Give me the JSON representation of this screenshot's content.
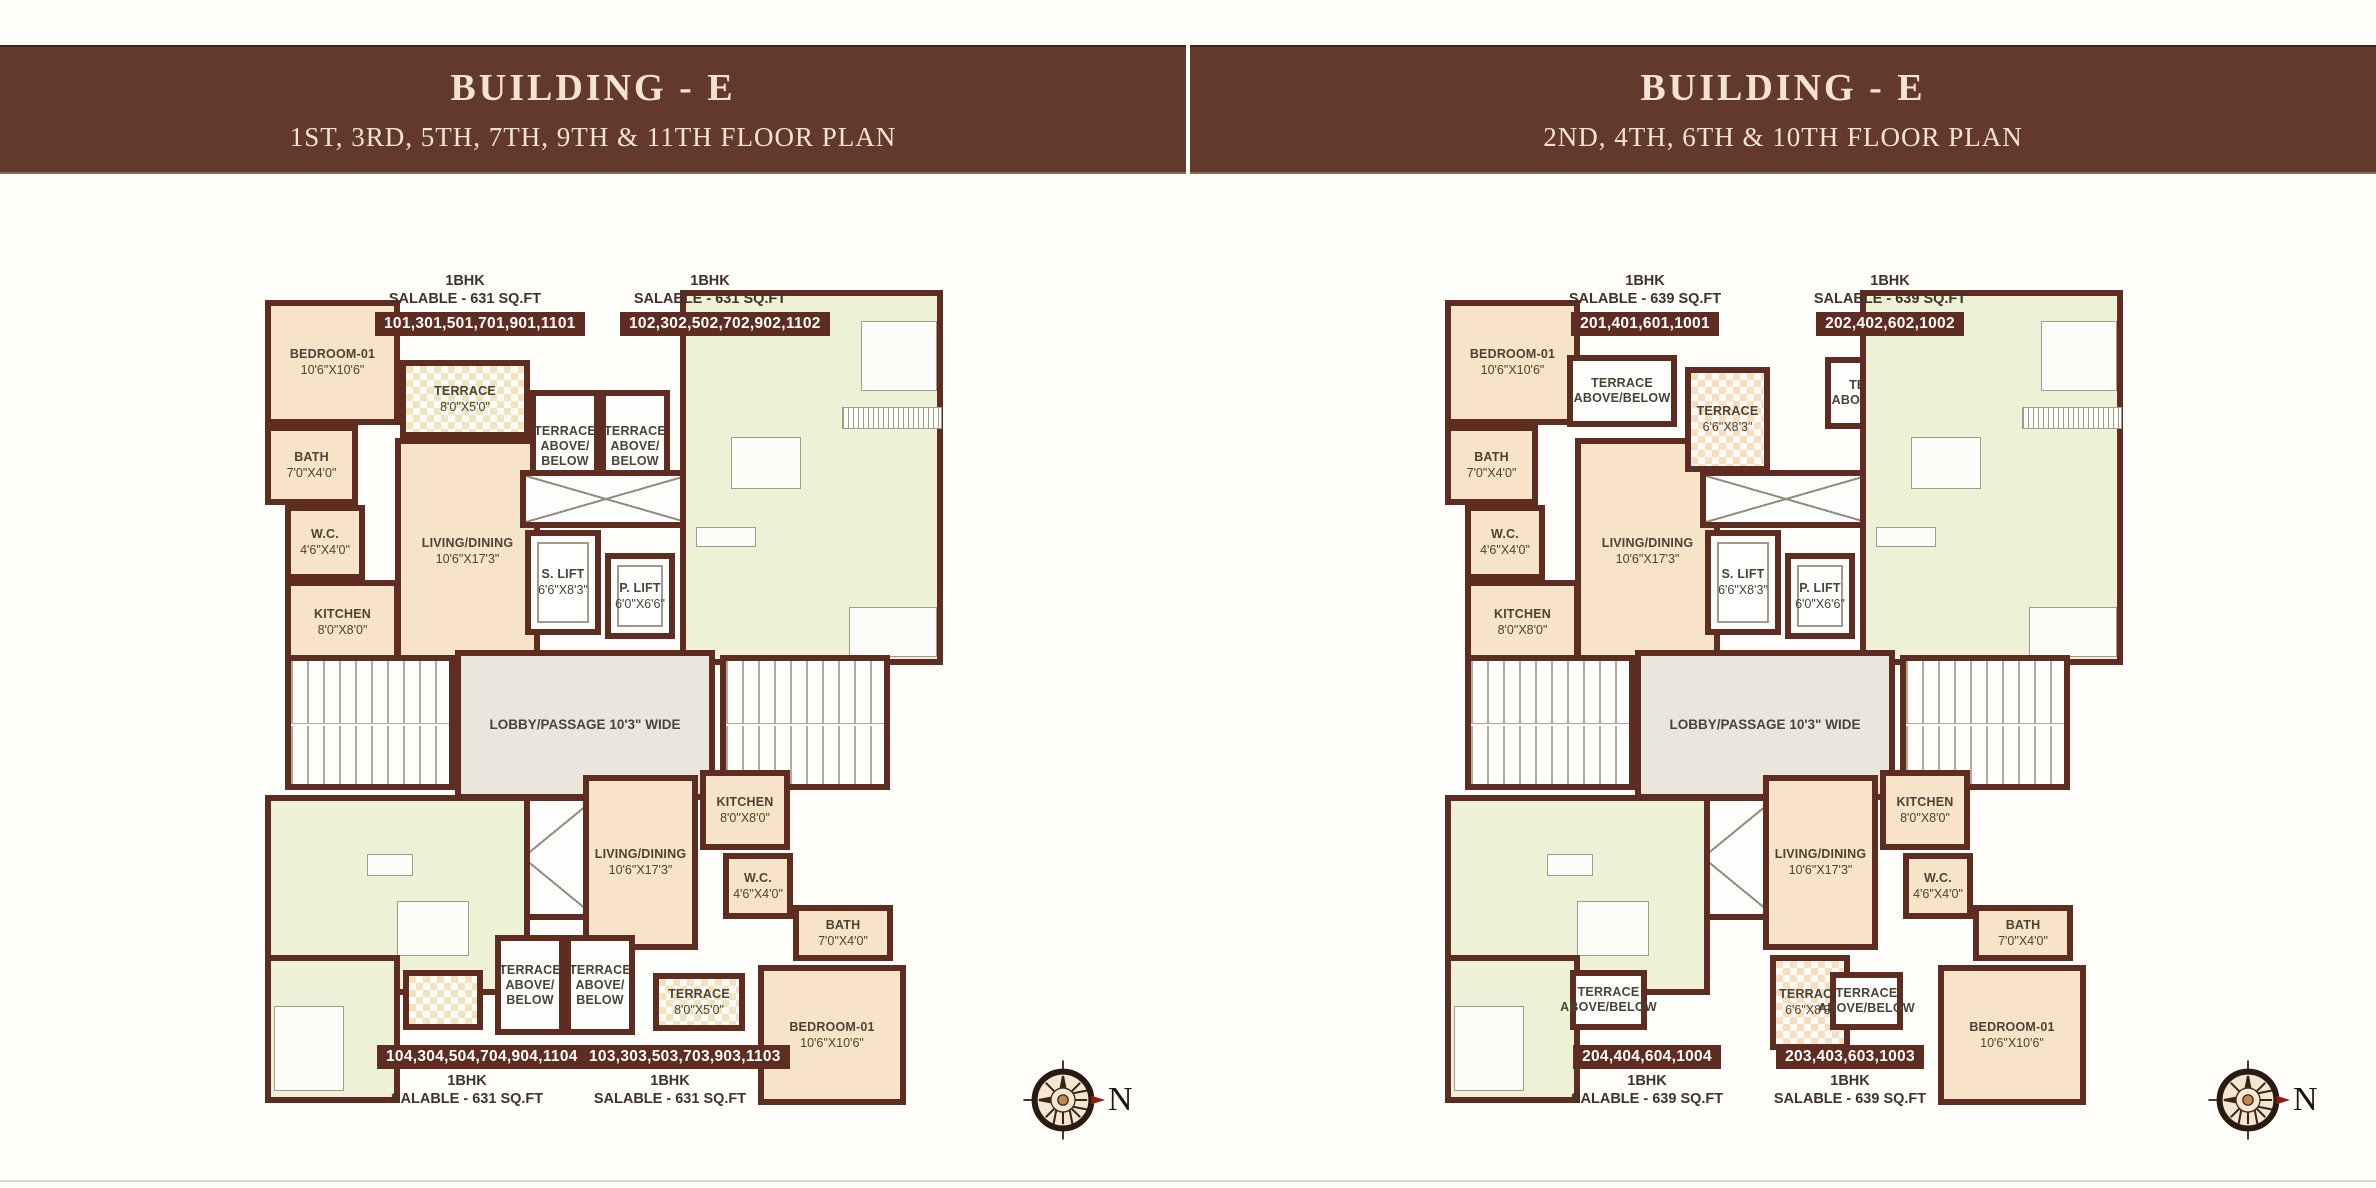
{
  "headers": [
    {
      "title": "BUILDING - E",
      "subtitle": "1ST, 3RD, 5TH, 7TH, 9TH & 11TH FLOOR PLAN"
    },
    {
      "title": "BUILDING - E",
      "subtitle": "2ND, 4TH, 6TH & 10TH FLOOR PLAN"
    }
  ],
  "colors": {
    "header_bg": "#63392b",
    "header_text": "#f2e3d3",
    "wall": "#5e2c20",
    "unit_peach": "#f7e3c7",
    "unit_green": "#edf1d6",
    "terrace_cream": "#f2e2bd",
    "lobby_grey": "#eae6dc",
    "badge_bg": "#5e2c20",
    "badge_text": "#ffffff",
    "compass_arrow_red": "#8d1d14"
  },
  "plans": [
    {
      "units": {
        "top_left": {
          "type": "1BHK",
          "salable": "SALABLE - 631 SQ.FT",
          "numbers": "101,301,501,701,901,1101"
        },
        "top_right": {
          "type": "1BHK",
          "salable": "SALABLE - 631 SQ.FT",
          "numbers": "102,302,502,702,902,1102"
        },
        "bottom_left": {
          "type": "1BHK",
          "salable": "SALABLE - 631 SQ.FT",
          "numbers": "104,304,504,704,904,1104"
        },
        "bottom_right": {
          "type": "1BHK",
          "salable": "SALABLE - 631 SQ.FT",
          "numbers": "103,303,503,703,903,1103"
        }
      },
      "rooms": {
        "bedroom": "BEDROOM-01",
        "bedroom_dims": "10'6\"X10'6\"",
        "bath": "BATH",
        "bath_dims": "7'0\"X4'0\"",
        "wc": "W.C.",
        "wc_dims": "4'6\"X4'0\"",
        "kitchen": "KITCHEN",
        "kitchen_dims": "8'0\"X8'0\"",
        "living": "LIVING/DINING",
        "living_dims": "10'6\"X17'3\"",
        "s_lift": "S. LIFT",
        "s_lift_dims": "6'6\"X8'3\"",
        "p_lift": "P. LIFT",
        "p_lift_dims": "6'0\"X6'6\"",
        "lobby": "LOBBY/PASSAGE 10'3\" WIDE"
      },
      "terraces": {
        "top": [
          {
            "name": "TERRACE",
            "dims": "8'0\"X5'0\""
          },
          {
            "name": "TERRACE ABOVE/ BELOW"
          },
          {
            "name": "TERRACE ABOVE/ BELOW"
          }
        ],
        "bottom": [
          {
            "name": "TERRACE ABOVE/ BELOW"
          },
          {
            "name": "TERRACE ABOVE/ BELOW"
          },
          {
            "name": "TERRACE",
            "dims": "8'0\"X5'0\""
          }
        ]
      },
      "compass": "N"
    },
    {
      "units": {
        "top_left": {
          "type": "1BHK",
          "salable": "SALABLE - 639 SQ.FT",
          "numbers": "201,401,601,1001"
        },
        "top_right": {
          "type": "1BHK",
          "salable": "SALABLE - 639 SQ.FT",
          "numbers": "202,402,602,1002"
        },
        "bottom_left": {
          "type": "1BHK",
          "salable": "SALABLE - 639 SQ.FT",
          "numbers": "204,404,604,1004"
        },
        "bottom_right": {
          "type": "1BHK",
          "salable": "SALABLE - 639 SQ.FT",
          "numbers": "203,403,603,1003"
        }
      },
      "rooms": {
        "bedroom": "BEDROOM-01",
        "bedroom_dims": "10'6\"X10'6\"",
        "bath": "BATH",
        "bath_dims": "7'0\"X4'0\"",
        "wc": "W.C.",
        "wc_dims": "4'6\"X4'0\"",
        "kitchen": "KITCHEN",
        "kitchen_dims": "8'0\"X8'0\"",
        "living": "LIVING/DINING",
        "living_dims": "10'6\"X17'3\"",
        "s_lift": "S. LIFT",
        "s_lift_dims": "6'6\"X8'3\"",
        "p_lift": "P. LIFT",
        "p_lift_dims": "6'0\"X6'6\"",
        "lobby": "LOBBY/PASSAGE 10'3\" WIDE"
      },
      "terraces": {
        "top": [
          {
            "name": "TERRACE ABOVE/BELOW"
          },
          {
            "name": "TERRACE",
            "dims": "6'6\"X8'3\""
          },
          {
            "name": "TERRACE ABOVE/BELOW"
          }
        ],
        "bottom": [
          {
            "name": "TERRACE ABOVE/BELOW"
          },
          {
            "name": "TERRACE",
            "dims": "6'6\"X8'3\""
          },
          {
            "name": "TERRACE ABOVE/BELOW"
          }
        ]
      },
      "compass": "N"
    }
  ]
}
